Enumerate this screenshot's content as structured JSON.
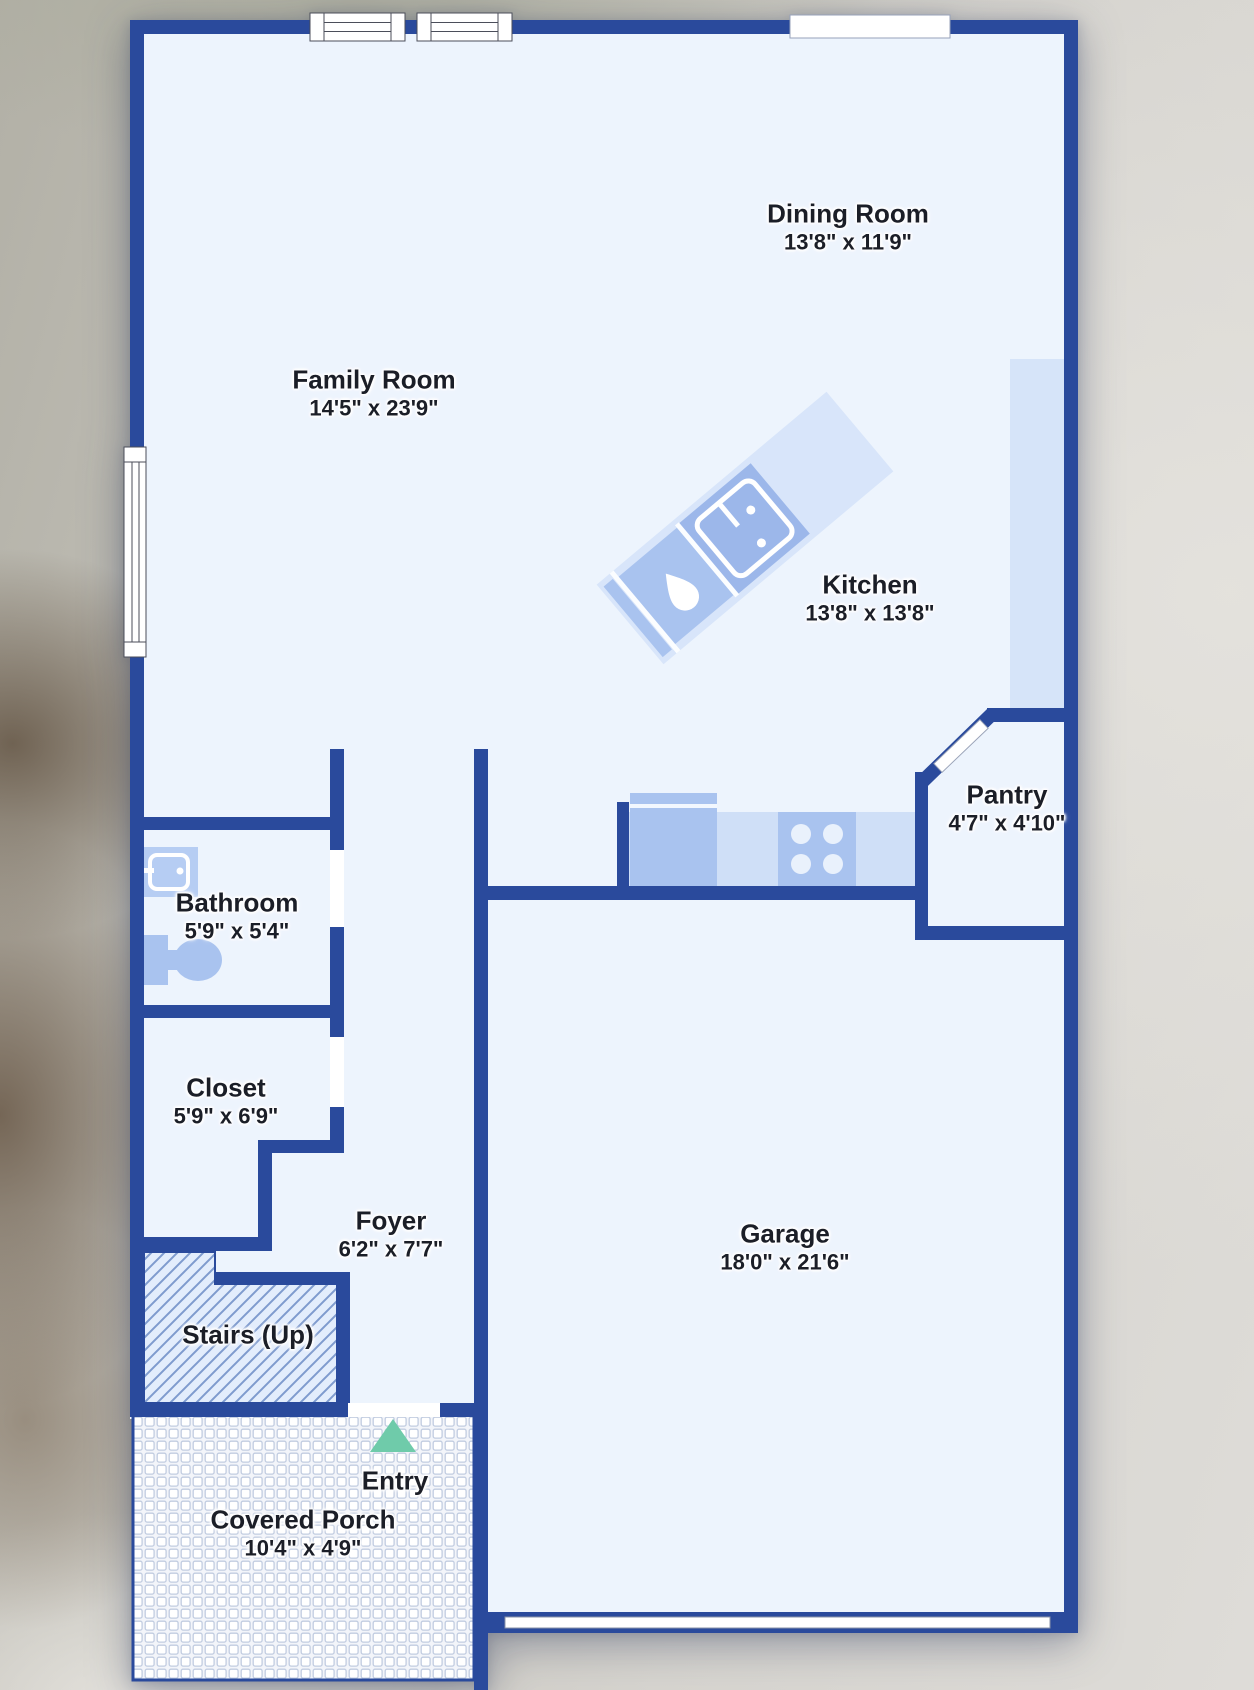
{
  "floorplan": {
    "rooms": [
      {
        "name": "Dining Room",
        "dims": "13'8\" x 11'9\""
      },
      {
        "name": "Family Room",
        "dims": "14'5\" x 23'9\""
      },
      {
        "name": "Kitchen",
        "dims": "13'8\" x 13'8\""
      },
      {
        "name": "Pantry",
        "dims": "4'7\" x 4'10\""
      },
      {
        "name": "Bathroom",
        "dims": "5'9\" x 5'4\""
      },
      {
        "name": "Closet",
        "dims": "5'9\" x 6'9\""
      },
      {
        "name": "Foyer",
        "dims": "6'2\" x 7'7\""
      },
      {
        "name": "Stairs (Up)",
        "dims": ""
      },
      {
        "name": "Garage",
        "dims": "18'0\" x 21'6\""
      },
      {
        "name": "Entry",
        "dims": ""
      },
      {
        "name": "Covered Porch",
        "dims": "10'4\" x 4'9\""
      }
    ],
    "icons": {
      "kitchen_island": "kitchen-island",
      "island_sink": "double-basin-sink",
      "dishwasher": "dishwasher-droplet",
      "refrigerator": "refrigerator",
      "stove": "stove-4-burners",
      "vanity": "bathroom-vanity-sink",
      "toilet": "toilet",
      "entry_arrow": "entry-direction-triangle",
      "windows": "window-symbol",
      "stairs": "diagonal-hatch",
      "porch": "tile-mosaic"
    },
    "colors": {
      "wall": "#2a4a9c",
      "floor": "#edf4fd",
      "fixture": "#a9c3ef",
      "counter": "#cfdff7",
      "island_slab": "#d8e5fa",
      "hatch_line": "#7f9bce",
      "entry_arrow": "#6fcbaa",
      "label_text": "#1b1e27"
    }
  }
}
